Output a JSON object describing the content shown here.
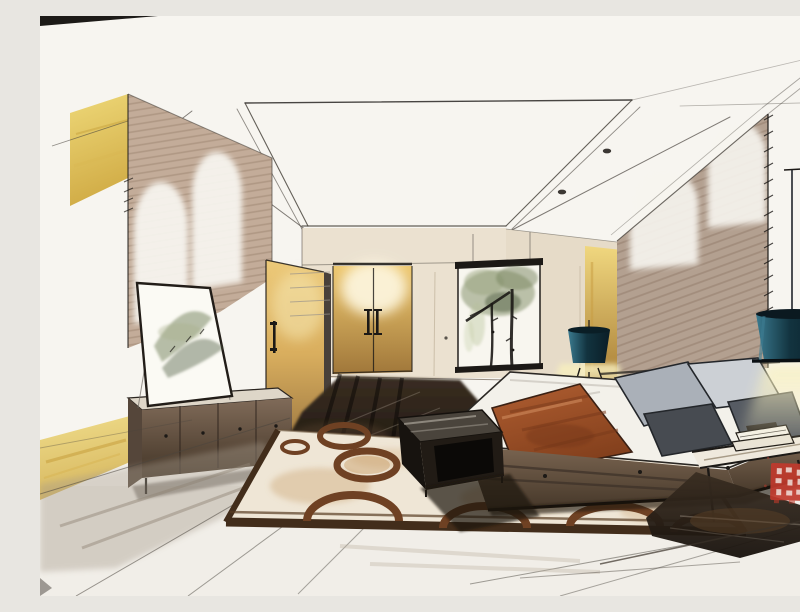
{
  "image": {
    "alt": "Hand-drawn marker and ink rendering of a modern bedroom interior in one-point perspective: recessed ceiling with downlights, tan walls washed by arched light scallops, gold-lit wardrobe doors, an ink-wash tree painting above the bed wall, a mountain ink painting leaning on a low dark sideboard beside a wooden door, a bed with gray pillows and a rust runner, teal lamps with warm yellow glow, a circle-patterned rug over a dark reflective floor, a faint watermark across the center and a square red artist seal at the right."
  },
  "palette": {
    "paper": "#f7f5f0",
    "line": "#4a453e",
    "ink": "#1c1916",
    "tan_wall": "#c3ac99",
    "taupe_wall": "#b3a090",
    "back_wall": "#ebe1d0",
    "yellow_panel": "#e9d06d",
    "gold_hi": "#ecc979",
    "gold_lo": "#926d38",
    "duvet": "#f3f1ea",
    "rust": "#a3552c",
    "rust_deep": "#7a3a1b",
    "pillow_gray": "#a8aeb6",
    "pillow_light": "#ccd0d5",
    "pillow_charcoal": "#474b51",
    "teal_deep": "#0f2e39",
    "teal_hi": "#3b7b90",
    "glow": "#f7efbe",
    "foliage": "#86936d",
    "foliage_deep": "#59674a",
    "dark_floor": "#261e17",
    "rug_field": "#efe6d6",
    "rug_tan": "#c79b63",
    "ring_brown": "#6f4123",
    "rug_border": "#422d1b",
    "seal_red": "#c03a2c"
  },
  "artifacts": {
    "seal_label": "square-red-artist-seal",
    "watermark_label": "faint-center-watermark"
  }
}
